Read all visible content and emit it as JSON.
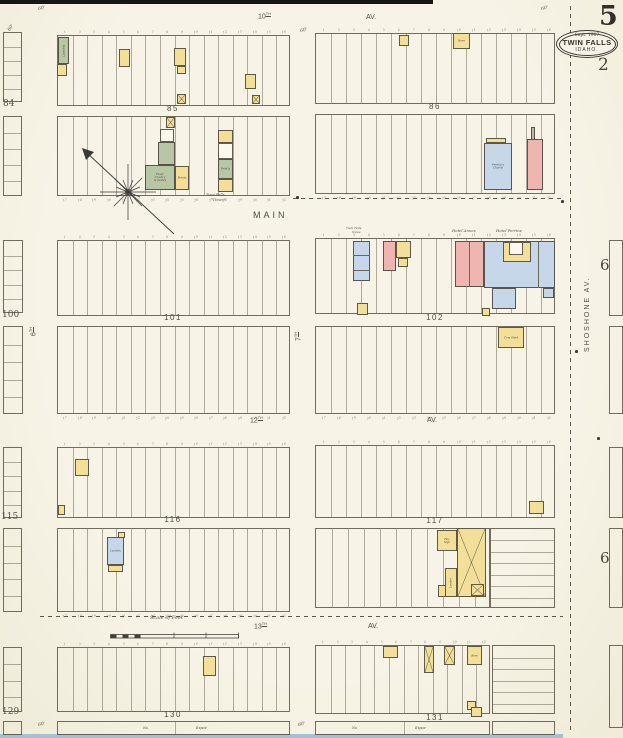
{
  "page": {
    "sheet_number": "5",
    "adjacent_sheet_number": "2",
    "right_sheet_numbers": [
      "6",
      "6"
    ],
    "date_line": "Sept. 1907",
    "city": "TWIN FALLS",
    "state": "IDAHO."
  },
  "palette": {
    "f": "#f2e09a",
    "b": "#efb5b0",
    "s": "#c7d7ea",
    "sp": "#b7c7a6",
    "w": "#fbf9ee",
    "g": "#b9b8ae",
    "ln": "#6b665a",
    "paper": "#f5f2e3",
    "ink": "#4a463d"
  },
  "map": {
    "street_labels": [
      {
        "t": "10",
        "sup": "TH",
        "x": 258,
        "y": 13,
        "s": 7
      },
      {
        "t": "AV.",
        "x": 366,
        "y": 14,
        "s": 7
      },
      {
        "t": "MAIN",
        "x": 253,
        "y": 211,
        "s": 9,
        "ls": 3
      },
      {
        "t": "12",
        "sup": "TH",
        "x": 250,
        "y": 417,
        "s": 7
      },
      {
        "t": "AV.",
        "x": 427,
        "y": 417,
        "s": 7
      },
      {
        "t": "13",
        "sup": "TH",
        "x": 254,
        "y": 623,
        "s": 7
      },
      {
        "t": "AV.",
        "x": 368,
        "y": 623,
        "s": 7
      },
      {
        "t": "6",
        "sup": "TH",
        "x": 30,
        "y": 336,
        "s": 7,
        "rot": -90
      },
      {
        "t": "7",
        "sup": "TH",
        "x": 295,
        "y": 341,
        "s": 7,
        "rot": -90
      },
      {
        "t": "SHOSHONE  AV.",
        "x": 584,
        "y": 352,
        "s": 7,
        "ls": 2,
        "rot": -90
      }
    ],
    "block_labels": [
      {
        "t": "85",
        "cx": 173,
        "y": 105
      },
      {
        "t": "86",
        "cx": 435,
        "y": 103
      },
      {
        "t": "101",
        "cx": 173,
        "y": 314
      },
      {
        "t": "102",
        "cx": 435,
        "y": 314
      },
      {
        "t": "116",
        "cx": 173,
        "y": 516
      },
      {
        "t": "117",
        "cx": 435,
        "y": 517
      },
      {
        "t": "130",
        "cx": 173,
        "y": 711
      },
      {
        "t": "131",
        "cx": 435,
        "y": 714
      }
    ],
    "lot_rows": [
      {
        "id": "85u",
        "x": 57,
        "y": 35,
        "w": 233,
        "h": 71,
        "lots": 16,
        "nums": "top"
      },
      {
        "id": "85l",
        "x": 57,
        "y": 116,
        "w": 233,
        "h": 80,
        "lots": 16,
        "nums": "bottom"
      },
      {
        "id": "86u",
        "x": 315,
        "y": 33,
        "w": 240,
        "h": 71,
        "lots": 16,
        "nums": "top"
      },
      {
        "id": "86l",
        "x": 315,
        "y": 114,
        "w": 240,
        "h": 80,
        "lots": 16,
        "nums": "bottom"
      },
      {
        "id": "101u",
        "x": 57,
        "y": 240,
        "w": 233,
        "h": 76,
        "lots": 16,
        "nums": "top"
      },
      {
        "id": "101l",
        "x": 57,
        "y": 326,
        "w": 233,
        "h": 88,
        "lots": 16,
        "nums": "bottom"
      },
      {
        "id": "102u",
        "x": 315,
        "y": 238,
        "w": 240,
        "h": 76,
        "lots": 16,
        "nums": "top"
      },
      {
        "id": "102l",
        "x": 315,
        "y": 326,
        "w": 240,
        "h": 88,
        "lots": 16,
        "nums": "bottom"
      },
      {
        "id": "116u",
        "x": 57,
        "y": 447,
        "w": 233,
        "h": 71,
        "lots": 16,
        "nums": "top"
      },
      {
        "id": "116l",
        "x": 57,
        "y": 528,
        "w": 233,
        "h": 84,
        "lots": 16,
        "nums": "bottom"
      },
      {
        "id": "117u",
        "x": 315,
        "y": 445,
        "w": 240,
        "h": 73,
        "lots": 16,
        "nums": "top"
      },
      {
        "id": "117l",
        "x": 315,
        "y": 528,
        "w": 175,
        "h": 80,
        "lots": 11
      },
      {
        "id": "117lr",
        "x": 490,
        "y": 528,
        "w": 65,
        "h": 80,
        "dir": "h",
        "lots": 7
      },
      {
        "id": "130",
        "x": 57,
        "y": 647,
        "w": 233,
        "h": 65,
        "lots": 16,
        "nums": "top"
      },
      {
        "id": "131",
        "x": 315,
        "y": 645,
        "w": 175,
        "h": 69,
        "lots": 12,
        "nums": "top"
      },
      {
        "id": "131r",
        "x": 492,
        "y": 645,
        "w": 63,
        "h": 69,
        "dir": "h",
        "lots": 6
      },
      {
        "id": "130s",
        "x": 57,
        "y": 721,
        "w": 233,
        "h": 14,
        "lots": 2
      },
      {
        "id": "131s",
        "x": 315,
        "y": 721,
        "w": 175,
        "h": 14,
        "lots": 2
      },
      {
        "id": "131rs",
        "x": 492,
        "y": 721,
        "w": 63,
        "h": 14,
        "lots": 1
      },
      {
        "id": "84u",
        "x": 3,
        "y": 32,
        "w": 19,
        "h": 70,
        "dir": "h",
        "lots": 5
      },
      {
        "id": "84l",
        "x": 3,
        "y": 116,
        "w": 19,
        "h": 80,
        "dir": "h",
        "lots": 5
      },
      {
        "id": "100u",
        "x": 3,
        "y": 240,
        "w": 20,
        "h": 73,
        "dir": "h",
        "lots": 5
      },
      {
        "id": "100l",
        "x": 3,
        "y": 326,
        "w": 20,
        "h": 88,
        "dir": "h",
        "lots": 5
      },
      {
        "id": "115u",
        "x": 3,
        "y": 447,
        "w": 19,
        "h": 71,
        "dir": "h",
        "lots": 5
      },
      {
        "id": "115l",
        "x": 3,
        "y": 528,
        "w": 19,
        "h": 84,
        "dir": "h",
        "lots": 5
      },
      {
        "id": "129",
        "x": 3,
        "y": 647,
        "w": 19,
        "h": 65,
        "dir": "h",
        "lots": 4
      },
      {
        "id": "129s",
        "x": 3,
        "y": 721,
        "w": 19,
        "h": 14,
        "lots": 1
      },
      {
        "id": "r1",
        "x": 609,
        "y": 240,
        "w": 14,
        "h": 76,
        "lots": 1
      },
      {
        "id": "r2",
        "x": 609,
        "y": 326,
        "w": 14,
        "h": 88,
        "lots": 1
      },
      {
        "id": "r3",
        "x": 609,
        "y": 447,
        "w": 14,
        "h": 71,
        "lots": 1
      },
      {
        "id": "r4",
        "x": 609,
        "y": 528,
        "w": 14,
        "h": 80,
        "lots": 1
      },
      {
        "id": "r5",
        "x": 609,
        "y": 645,
        "w": 14,
        "h": 83,
        "lots": 1
      }
    ],
    "buildings": [
      {
        "x": 58,
        "y": 37,
        "w": 11,
        "h": 27,
        "c": "sp",
        "label": "Laundry",
        "rot": -90,
        "size": 2.8
      },
      {
        "x": 57,
        "y": 64,
        "w": 10,
        "h": 12,
        "c": "f"
      },
      {
        "x": 119,
        "y": 49,
        "w": 11,
        "h": 18,
        "c": "f"
      },
      {
        "x": 174,
        "y": 48,
        "w": 12,
        "h": 18,
        "c": "f"
      },
      {
        "x": 177,
        "y": 66,
        "w": 9,
        "h": 8,
        "c": "f"
      },
      {
        "x": 245,
        "y": 74,
        "w": 11,
        "h": 15,
        "c": "f"
      },
      {
        "x": 177,
        "y": 94,
        "w": 9,
        "h": 10,
        "c": "f",
        "cross": true
      },
      {
        "x": 252,
        "y": 95,
        "w": 8,
        "h": 9,
        "c": "f",
        "cross": true
      },
      {
        "x": 166,
        "y": 117,
        "w": 9,
        "h": 11,
        "c": "f",
        "cross": true
      },
      {
        "x": 160,
        "y": 129,
        "w": 14,
        "h": 13,
        "c": "w"
      },
      {
        "x": 158,
        "y": 142,
        "w": 17,
        "h": 23,
        "c": "sp"
      },
      {
        "x": 145,
        "y": 165,
        "w": 30,
        "h": 25,
        "c": "sp",
        "label": "Flour\nCrock'y\n& Paints",
        "size": 2.8
      },
      {
        "x": 175,
        "y": 166,
        "w": 14,
        "h": 24,
        "c": "f",
        "label": "Paints",
        "size": 2.8
      },
      {
        "x": 218,
        "y": 130,
        "w": 15,
        "h": 13,
        "c": "f"
      },
      {
        "x": 218,
        "y": 143,
        "w": 15,
        "h": 16,
        "c": "w"
      },
      {
        "x": 218,
        "y": 159,
        "w": 15,
        "h": 20,
        "c": "sp",
        "label": "Print'g",
        "size": 2.6
      },
      {
        "x": 218,
        "y": 179,
        "w": 15,
        "h": 13,
        "c": "f"
      },
      {
        "x": 399,
        "y": 35,
        "w": 10,
        "h": 11,
        "c": "f"
      },
      {
        "x": 453,
        "y": 33,
        "w": 17,
        "h": 16,
        "c": "f",
        "label": "Barn",
        "size": 2.8
      },
      {
        "x": 486,
        "y": 138,
        "w": 20,
        "h": 5,
        "c": "f"
      },
      {
        "x": 484,
        "y": 143,
        "w": 28,
        "h": 47,
        "c": "s",
        "label": "Presby'n\nChurch",
        "size": 2.8
      },
      {
        "x": 531,
        "y": 127,
        "w": 4,
        "h": 13,
        "c": "g"
      },
      {
        "x": 527,
        "y": 139,
        "w": 16,
        "h": 51,
        "c": "b"
      },
      {
        "x": 353,
        "y": 241,
        "w": 17,
        "h": 40,
        "c": "s"
      },
      {
        "x": 353,
        "y": 255,
        "w": 17,
        "h": 1,
        "c": "ln"
      },
      {
        "x": 353,
        "y": 270,
        "w": 17,
        "h": 1,
        "c": "ln"
      },
      {
        "x": 383,
        "y": 241,
        "w": 13,
        "h": 30,
        "c": "b"
      },
      {
        "x": 396,
        "y": 241,
        "w": 15,
        "h": 17,
        "c": "f"
      },
      {
        "x": 398,
        "y": 258,
        "w": 10,
        "h": 9,
        "c": "f"
      },
      {
        "x": 455,
        "y": 241,
        "w": 29,
        "h": 46,
        "c": "b"
      },
      {
        "x": 469,
        "y": 242,
        "w": 1,
        "h": 45,
        "c": "ln"
      },
      {
        "x": 484,
        "y": 241,
        "w": 71,
        "h": 47,
        "c": "s"
      },
      {
        "x": 538,
        "y": 242,
        "w": 1,
        "h": 46,
        "c": "ln"
      },
      {
        "x": 503,
        "y": 242,
        "w": 28,
        "h": 20,
        "c": "f"
      },
      {
        "x": 509,
        "y": 242,
        "w": 14,
        "h": 13,
        "c": "w"
      },
      {
        "x": 492,
        "y": 288,
        "w": 24,
        "h": 21,
        "c": "s"
      },
      {
        "x": 543,
        "y": 288,
        "w": 11,
        "h": 10,
        "c": "s"
      },
      {
        "x": 357,
        "y": 303,
        "w": 11,
        "h": 12,
        "c": "f"
      },
      {
        "x": 482,
        "y": 308,
        "w": 8,
        "h": 8,
        "c": "f"
      },
      {
        "x": 498,
        "y": 327,
        "w": 26,
        "h": 21,
        "c": "f",
        "label": "Cow Shed",
        "size": 2.8
      },
      {
        "x": 75,
        "y": 459,
        "w": 14,
        "h": 17,
        "c": "f"
      },
      {
        "x": 58,
        "y": 505,
        "w": 7,
        "h": 10,
        "c": "f"
      },
      {
        "x": 118,
        "y": 532,
        "w": 7,
        "h": 6,
        "c": "f"
      },
      {
        "x": 107,
        "y": 537,
        "w": 17,
        "h": 28,
        "c": "s",
        "label": "Laundry",
        "size": 2.5
      },
      {
        "x": 108,
        "y": 565,
        "w": 15,
        "h": 7,
        "c": "f"
      },
      {
        "x": 529,
        "y": 501,
        "w": 15,
        "h": 13,
        "c": "f"
      },
      {
        "x": 437,
        "y": 530,
        "w": 20,
        "h": 21,
        "c": "f",
        "label": "Hay\nStge",
        "size": 2.6
      },
      {
        "x": 457,
        "y": 528,
        "w": 29,
        "h": 69,
        "c": "f",
        "cross": true
      },
      {
        "x": 445,
        "y": 568,
        "w": 12,
        "h": 29,
        "c": "f",
        "label": "Lumber",
        "rot": -90,
        "size": 2.6
      },
      {
        "x": 438,
        "y": 585,
        "w": 8,
        "h": 12,
        "c": "f"
      },
      {
        "x": 471,
        "y": 584,
        "w": 13,
        "h": 12,
        "c": "f",
        "cross": true
      },
      {
        "x": 203,
        "y": 656,
        "w": 13,
        "h": 20,
        "c": "f"
      },
      {
        "x": 383,
        "y": 646,
        "w": 15,
        "h": 12,
        "c": "f"
      },
      {
        "x": 424,
        "y": 646,
        "w": 10,
        "h": 27,
        "c": "f",
        "cross": true
      },
      {
        "x": 444,
        "y": 646,
        "w": 11,
        "h": 19,
        "c": "f",
        "cross": true
      },
      {
        "x": 467,
        "y": 646,
        "w": 15,
        "h": 19,
        "c": "f",
        "label": "Barn",
        "size": 2.6
      },
      {
        "x": 467,
        "y": 701,
        "w": 9,
        "h": 9,
        "c": "f"
      },
      {
        "x": 471,
        "y": 707,
        "w": 11,
        "h": 10,
        "c": "f"
      }
    ],
    "annotations": [
      {
        "t": "Twin Falls",
        "x": 346,
        "y": 227,
        "s": 3,
        "i": 1
      },
      {
        "t": "News",
        "x": 352,
        "y": 231,
        "s": 3,
        "i": 1
      },
      {
        "t": "Hotel Annex",
        "x": 452,
        "y": 229,
        "s": 3.8,
        "i": 1
      },
      {
        "t": "Hotel Perrine",
        "x": 496,
        "y": 229,
        "s": 3.8,
        "i": 1
      },
      {
        "t": "Twin Falls",
        "x": 206,
        "y": 194,
        "s": 3.6,
        "i": 1
      },
      {
        "t": "\"Times\"",
        "x": 211,
        "y": 199,
        "s": 3.6,
        "i": 1
      },
      {
        "t": "Scale of Feet",
        "x": 150,
        "y": 616,
        "s": 5,
        "i": 1
      },
      {
        "t": "84",
        "x": 3,
        "y": 100,
        "s": 9
      },
      {
        "t": "100",
        "x": 2,
        "y": 311,
        "s": 9
      },
      {
        "t": "115",
        "x": 1,
        "y": 513,
        "s": 9
      },
      {
        "t": "129",
        "x": 2,
        "y": 708,
        "s": 9
      },
      {
        "t": "No",
        "x": 143,
        "y": 727,
        "s": 3.4,
        "i": 1
      },
      {
        "t": "Expos-",
        "x": 196,
        "y": 727,
        "s": 3.4,
        "i": 1
      },
      {
        "t": "No",
        "x": 352,
        "y": 727,
        "s": 3.4,
        "i": 1
      },
      {
        "t": "Expos-",
        "x": 415,
        "y": 727,
        "s": 3.4,
        "i": 1
      },
      {
        "t": "60'",
        "x": 38,
        "y": 8,
        "s": 4.5,
        "i": 1,
        "r": -12
      },
      {
        "t": "60'",
        "x": 300,
        "y": 30,
        "s": 4.5,
        "i": 1,
        "r": -12
      },
      {
        "t": "60'",
        "x": 541,
        "y": 8,
        "s": 4.5,
        "i": 1,
        "r": -12
      },
      {
        "t": "60'",
        "x": 38,
        "y": 724,
        "s": 4.5,
        "i": 1,
        "r": -12
      },
      {
        "t": "60'",
        "x": 298,
        "y": 724,
        "s": 4.5,
        "i": 1,
        "r": -12
      },
      {
        "t": "60'",
        "x": 8,
        "y": 30,
        "s": 4.5,
        "i": 1,
        "r": -55
      }
    ],
    "dashed_lines": [
      {
        "o": "h",
        "x": 293,
        "y": 198,
        "len": 270
      },
      {
        "o": "h",
        "x": 40,
        "y": 616,
        "len": 523
      },
      {
        "o": "v",
        "x": 570,
        "y": 6,
        "len": 728
      }
    ],
    "dots": [
      {
        "x": 296,
        "y": 196
      },
      {
        "x": 561,
        "y": 200
      },
      {
        "x": 575,
        "y": 350
      },
      {
        "x": 597,
        "y": 437
      }
    ]
  }
}
